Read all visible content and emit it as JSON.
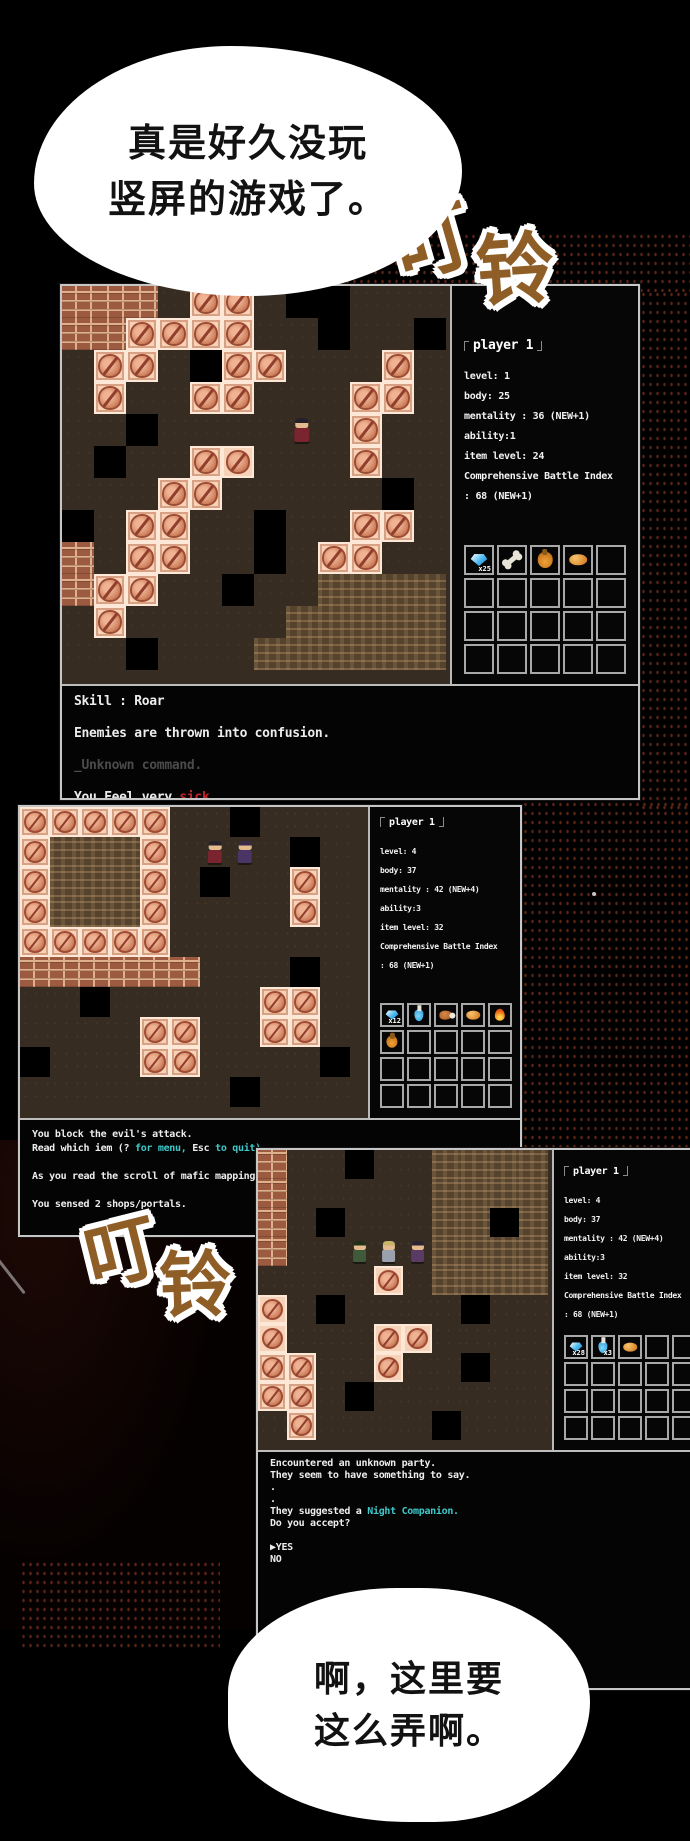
{
  "colors": {
    "accent_cyan": "#3fc8ca",
    "alert_red": "#c3272b",
    "sfx_brown": "#8f5d26",
    "tile_pink": "#f6d2b8",
    "window_border": "#c6c6c6",
    "background": "#000000"
  },
  "bubbles": [
    {
      "lines": [
        "真是好久没玩",
        "竖屏的游戏了。"
      ]
    },
    {
      "lines": [
        "啊，这里要",
        "这么弄啊。"
      ]
    }
  ],
  "sfx": {
    "text": "叮铃",
    "chars": [
      "叮",
      "铃"
    ]
  },
  "map_legend": {
    ".": "t-floor",
    "#": "t-void",
    "B": "t-brick",
    "T": "t-ptile",
    "t": "t-ptile t-sm",
    "W": "t-sand",
    "P": "t-floor sprite sp-hero",
    "Q": "t-floor sprite sp-mage",
    "1": "t-floor sprite sp-a",
    "2": "t-floor sprite sp-b",
    "3": "t-floor sprite sp-c"
  },
  "panels": [
    {
      "player": "player 1",
      "stats": [
        "level: 1",
        "body: 25",
        "mentality : 36 (NEW+1)",
        "ability:1",
        "item level: 24",
        "Comprehensive Battle Index",
        ": 68 (NEW+1)"
      ],
      "inventory": {
        "cols": 5,
        "rows": 4,
        "items": [
          {
            "type": "crystal",
            "badge": "x25"
          },
          {
            "type": "bone"
          },
          {
            "type": "bag"
          },
          {
            "type": "bread"
          }
        ]
      },
      "map": {
        "tile": 32,
        "rows": [
          "BBB.TT.##...",
          "BBTTTT..#..#",
          ".TT.#TT...T.",
          ".T..TT...TT.",
          "..#....P.T..",
          ".#..Tt...T..",
          "...TT.....#.",
          "#.TT..#..TT.",
          "B.TT..#.TT..",
          "BTT..#..WWWW",
          ".T.....WWWWW",
          "..#...WWWWWW"
        ]
      },
      "log": [
        "Skill : Roar",
        "",
        "Enemies are thrown into confusion.",
        "",
        [
          {
            "t": "_Unknown command.",
            "c": "dim"
          }
        ],
        "",
        [
          {
            "t": "You Feel very "
          },
          {
            "t": "sick.",
            "c": "red"
          }
        ]
      ]
    },
    {
      "player": "player 1",
      "stats": [
        "level: 4",
        "body: 37",
        "mentality : 42 (NEW+4)",
        "ability:3",
        "item level: 32",
        "Comprehensive Battle Index",
        ": 68 (NEW+1)"
      ],
      "inventory": {
        "cols": 5,
        "rows": 4,
        "items": [
          {
            "type": "crystal",
            "badge": "x12"
          },
          {
            "type": "potion"
          },
          {
            "type": "meat"
          },
          {
            "type": "bread"
          },
          {
            "type": "fire"
          },
          {
            "type": "bag"
          }
        ]
      },
      "map": {
        "tile": 30,
        "rows": [
          "TTTTT..#...",
          "TWWWT.PQ.#.",
          "TWWWT.#..T.",
          "TWWWT....T.",
          "TTTTT......",
          "BBBBBB...#.",
          "..#.....TT.",
          "....TT..TT.",
          "#...TT....#",
          ".......#..."
        ]
      },
      "log": [
        "You block the evil's attack.",
        [
          {
            "t": "Read which iem (? "
          },
          {
            "t": "for menu,",
            "c": "cyan"
          },
          {
            "t": " Esc "
          },
          {
            "t": "to quit)",
            "c": "cyan"
          }
        ],
        "",
        "As you read the scroll of mafic mapping...",
        "",
        "You sensed 2 shops/portals."
      ]
    },
    {
      "player": "player 1",
      "stats": [
        "level: 4",
        "body: 37",
        "mentality : 42 (NEW+4)",
        "ability:3",
        "item level: 32",
        "Comprehensive Battle Index",
        ": 68 (NEW+1)"
      ],
      "inventory": {
        "cols": 5,
        "rows": 4,
        "items": [
          {
            "type": "crystal",
            "badge": "x28"
          },
          {
            "type": "potion",
            "badge": "x3"
          },
          {
            "type": "bread"
          }
        ]
      },
      "map": {
        "tile": 29,
        "rows": [
          "B..#..WWWW",
          "B.....WWWW",
          "B.#...WW#W",
          "B..123WWWW",
          "....t.WWWW",
          "t.#....#..",
          "t...tt....",
          "TT..t..#..",
          "TT.#......",
          ".T....#..."
        ]
      },
      "log": [
        "Encountered an unknown party.",
        "They seem to have something to say.",
        ".",
        ".",
        [
          {
            "t": "They suggested a "
          },
          {
            "t": "Night Companion.",
            "c": "cyan"
          }
        ],
        "Do you accept?",
        "",
        "▶YES",
        "NO"
      ]
    }
  ]
}
